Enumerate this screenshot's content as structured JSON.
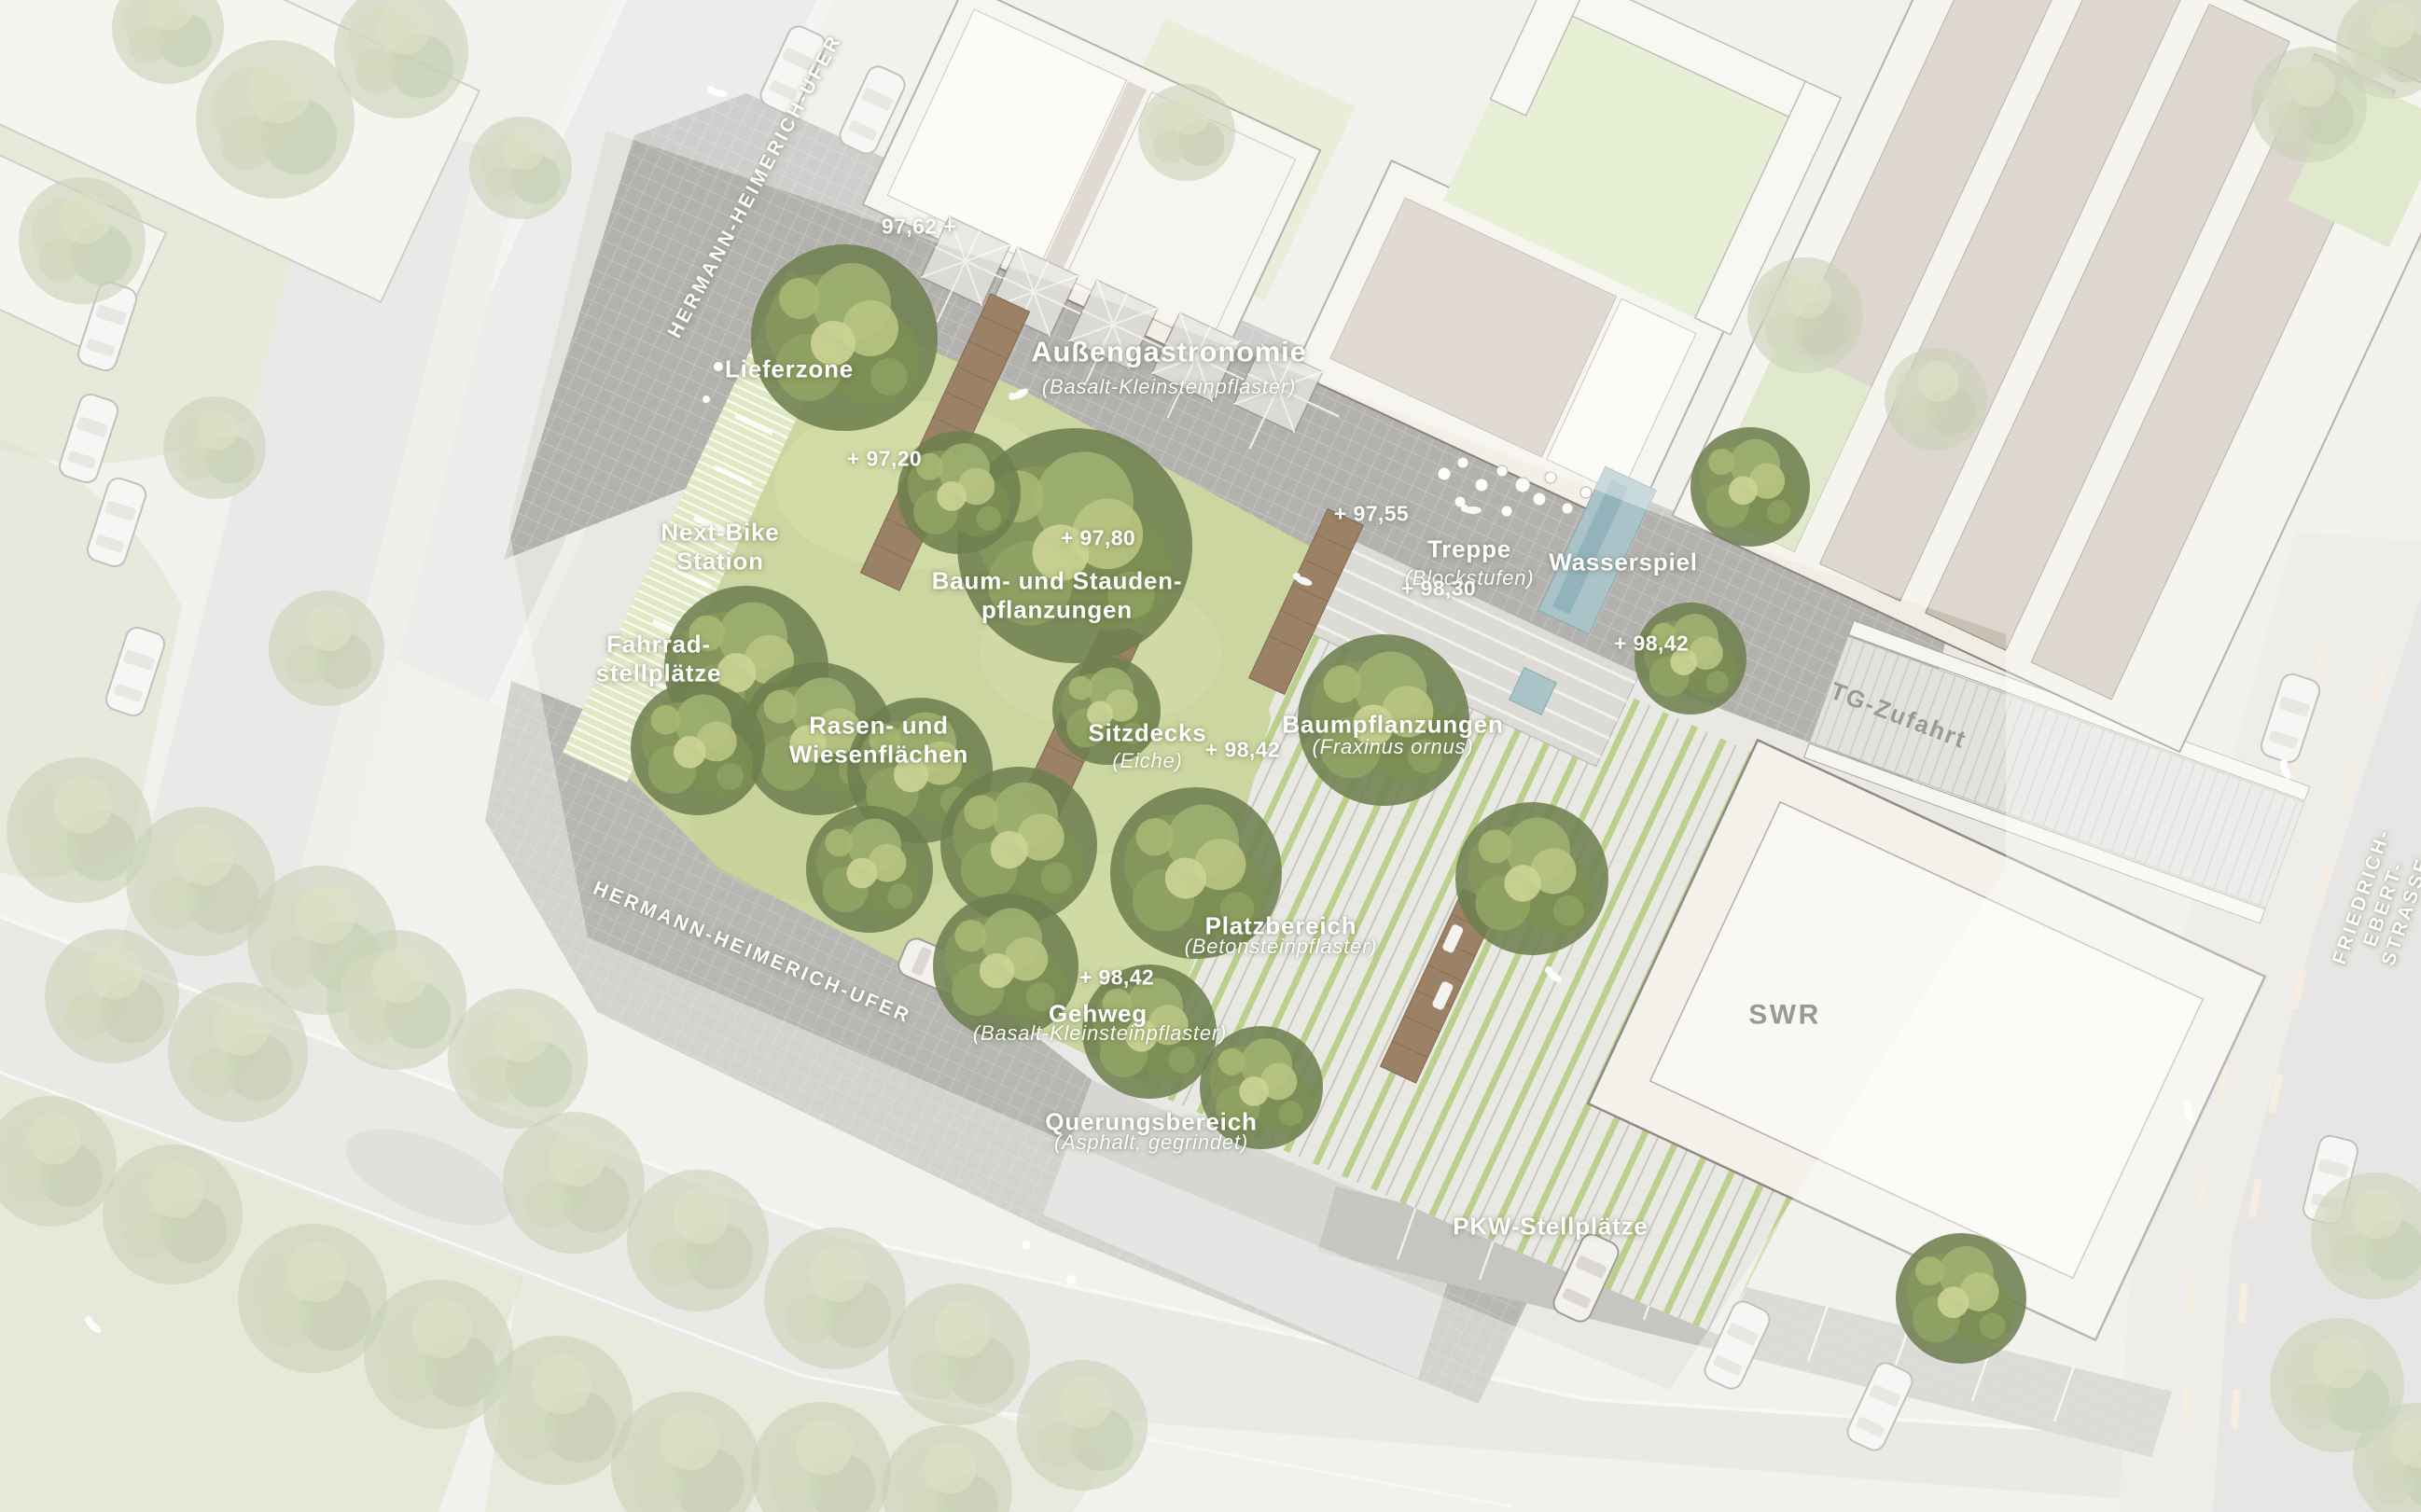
{
  "plan": {
    "streets": {
      "top": "HERMANN-HEIMERICH-UFER",
      "bottom": "HERMANN-HEIMERICH-UFER",
      "right": "FRIEDRICH-EBERT-STRASSE"
    },
    "zones": {
      "lieferzone": "Lieferzone",
      "aussengastronomie": "Außengastronomie",
      "aussengastronomie_sub": "(Basalt-Kleinsteinpflaster)",
      "nextbike": "Next-Bike\nStation",
      "fahrrad": "Fahrrad-\nstellplätze",
      "baumstauden": "Baum- und Stauden-\npflanzungen",
      "rasen": "Rasen- und\nWiesenflächen",
      "sitzdecks": "Sitzdecks",
      "sitzdecks_sub": "(Eiche)",
      "treppe": "Treppe",
      "treppe_sub": "(Blockstufen)",
      "wasserspiel": "Wasserspiel",
      "baumpflanzungen": "Baumpflanzungen",
      "baumpflanzungen_sub": "(Fraxinus ornus)",
      "platzbereich": "Platzbereich",
      "platzbereich_sub": "(Betonsteinpflaster)",
      "gehweg": "Gehweg",
      "gehweg_sub": "(Basalt-Kleinsteinpflaster)",
      "querung": "Querungsbereich",
      "querung_sub": "(Asphalt, gegrindet)",
      "pkw": "PKW-Stellplätze",
      "tg_zufahrt": "TG-Zufahrt"
    },
    "elevations": {
      "e_97_62": "97,62 +",
      "e_97_20": "+ 97,20",
      "e_97_80": "+ 97,80",
      "e_97_55": "+ 97,55",
      "e_98_30": "+ 98,30",
      "e_98_42_a": "+ 98,42",
      "e_98_42_b": "+ 98,42",
      "e_98_42_c": "+ 98,42"
    },
    "buildings": {
      "swr": "SWR"
    },
    "colors": {
      "lawn_green": "#ccd6a0",
      "tree_green": "#7d9055",
      "paving_gray": "#b2b1ad",
      "plaza_joint_green": "#bcd08d",
      "water_blue": "#a9c3c9",
      "deck_brown": "#9b8166",
      "building_cream": "#f3efe8",
      "building_taupe": "#c9bfb2",
      "street_gray": "#dcdbd7",
      "label_white": "#ffffff",
      "label_gray": "#9b9994"
    }
  }
}
